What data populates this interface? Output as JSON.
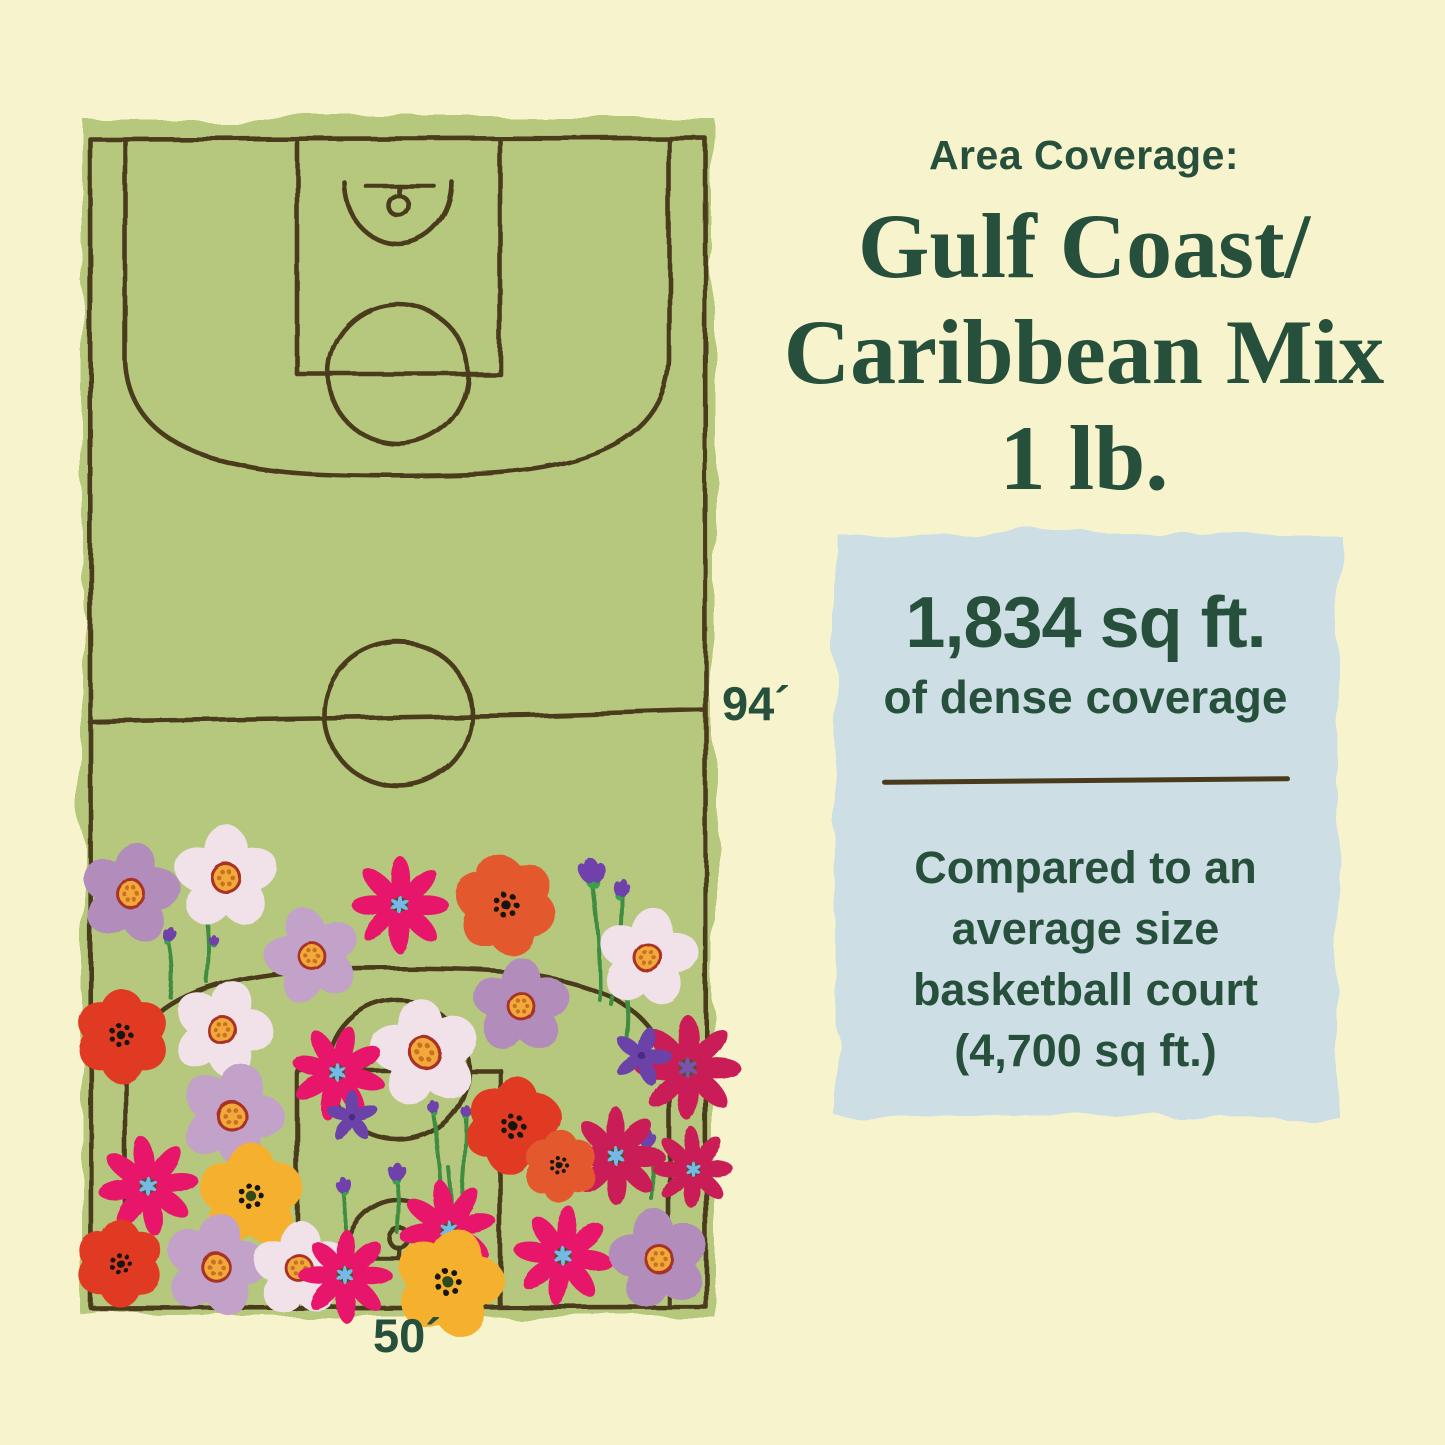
{
  "header": {
    "kicker": "Area Coverage:",
    "title_lines": [
      "Gulf Coast/",
      "Caribbean Mix",
      "1 lb."
    ]
  },
  "infobox": {
    "headline": "1,834 sq ft.",
    "subheadline": "of dense coverage",
    "note": "Compared to an average size basketball court (4,700 sq ft.)"
  },
  "court": {
    "length_label": "94´",
    "width_label": "50´"
  },
  "colors": {
    "background": "#f7f4cd",
    "court_green": "#b5c87b",
    "court_mottle": "#8fa352",
    "line_brown": "#4a3a1c",
    "text_green": "#27503c",
    "infobox_blue": "#cddfe5"
  },
  "illustration": {
    "palette": {
      "lav1": "#b28cba",
      "lav2": "#c2a2c9",
      "pale": "#f1e2ea",
      "mag": "#e7196a",
      "crim": "#ca1e56",
      "red": "#e03b22",
      "org": "#e4592e",
      "yellow": "#f5b12f",
      "iris": "#6b42a8",
      "bud": "#7040ab",
      "bud_green": "#3aa04c",
      "stem": "#3f8c3f",
      "blossom_ring": "#a93328",
      "blossom_disc": "#f1a93a",
      "blossom_dots": "#c96f22",
      "cosmos_disc": "#54512b",
      "star_blue": "#74b9e8",
      "star_purple": "#7a52ad",
      "poppy_dots": "#191208",
      "yellow_disc": "#2f4a1e"
    },
    "stems": [
      [
        600,
        1000,
        592,
        878
      ],
      [
        612,
        1005,
        621,
        892
      ],
      [
        445,
        1252,
        433,
        1112
      ],
      [
        456,
        1252,
        466,
        1116
      ],
      [
        450,
        1256,
        449,
        1168
      ],
      [
        207,
        982,
        206,
        912
      ],
      [
        171,
        998,
        169,
        942
      ],
      [
        397,
        1232,
        396,
        1176
      ],
      [
        344,
        1242,
        342,
        1190
      ],
      [
        651,
        1198,
        648,
        1144
      ],
      [
        627,
        1038,
        624,
        982
      ],
      [
        303,
        970,
        303,
        932
      ]
    ],
    "buds": [
      [
        206,
        903,
        20,
        -10
      ],
      [
        170,
        934,
        13,
        15
      ],
      [
        214,
        940,
        9,
        0
      ],
      [
        592,
        870,
        22,
        -8
      ],
      [
        621,
        886,
        15,
        18
      ],
      [
        433,
        1106,
        11,
        -12
      ],
      [
        466,
        1110,
        10,
        10
      ],
      [
        396,
        1170,
        16,
        0
      ],
      [
        342,
        1183,
        14,
        -12
      ],
      [
        648,
        1138,
        15,
        10
      ],
      [
        624,
        976,
        13,
        0
      ],
      [
        303,
        928,
        13,
        8
      ]
    ],
    "flowers": [
      {
        "t": "blossom",
        "c": "lav1",
        "x": 130,
        "y": 893,
        "r": 50,
        "a": 10
      },
      {
        "t": "blossom",
        "c": "pale",
        "x": 226,
        "y": 878,
        "r": 52,
        "a": 0
      },
      {
        "t": "cosmos",
        "c": "mag",
        "x": 400,
        "y": 905,
        "r": 48,
        "a": 0,
        "s": "star_blue"
      },
      {
        "t": "poppy",
        "c": "org",
        "x": 506,
        "y": 905,
        "r": 52,
        "a": -12
      },
      {
        "t": "blossom",
        "c": "lav2",
        "x": 312,
        "y": 956,
        "r": 48,
        "a": -15
      },
      {
        "t": "blossom",
        "c": "pale",
        "x": 648,
        "y": 958,
        "r": 50,
        "a": 8
      },
      {
        "t": "blossom",
        "c": "lav1",
        "x": 521,
        "y": 1006,
        "r": 48,
        "a": 0
      },
      {
        "t": "poppy",
        "c": "red",
        "x": 122,
        "y": 1036,
        "r": 48,
        "a": 0
      },
      {
        "t": "blossom",
        "c": "pale",
        "x": 222,
        "y": 1030,
        "r": 50,
        "a": 18
      },
      {
        "t": "cosmos",
        "c": "crim",
        "x": 688,
        "y": 1068,
        "r": 52,
        "a": 0,
        "s": "star_purple"
      },
      {
        "t": "iris",
        "x": 642,
        "y": 1056,
        "r": 30,
        "a": 18
      },
      {
        "t": "blossom",
        "c": "pale",
        "x": 425,
        "y": 1053,
        "r": 54,
        "a": -8
      },
      {
        "t": "cosmos",
        "c": "mag",
        "x": 338,
        "y": 1073,
        "r": 47,
        "a": 15,
        "s": "star_blue"
      },
      {
        "t": "blossom",
        "c": "lav2",
        "x": 232,
        "y": 1116,
        "r": 52,
        "a": 20
      },
      {
        "t": "iris",
        "x": 352,
        "y": 1117,
        "r": 27,
        "a": 0
      },
      {
        "t": "poppy",
        "c": "red",
        "x": 513,
        "y": 1126,
        "r": 50,
        "a": 8
      },
      {
        "t": "cosmos",
        "c": "crim",
        "x": 616,
        "y": 1156,
        "r": 48,
        "a": 0,
        "s": "star_blue"
      },
      {
        "t": "cosmos",
        "c": "mag",
        "x": 148,
        "y": 1186,
        "r": 49,
        "a": -8,
        "s": "star_blue"
      },
      {
        "t": "yellow",
        "x": 251,
        "y": 1196,
        "r": 52,
        "a": 0
      },
      {
        "t": "poppy",
        "c": "org",
        "x": 560,
        "y": 1166,
        "r": 38,
        "a": 0
      },
      {
        "t": "cosmos",
        "c": "mag",
        "x": 448,
        "y": 1229,
        "r": 48,
        "a": -10,
        "s": "star_blue"
      },
      {
        "t": "poppy",
        "c": "red",
        "x": 120,
        "y": 1263,
        "r": 45,
        "a": 0
      },
      {
        "t": "blossom",
        "c": "lav2",
        "x": 215,
        "y": 1266,
        "r": 51,
        "a": 12
      },
      {
        "t": "blossom",
        "c": "pale",
        "x": 300,
        "y": 1269,
        "r": 48,
        "a": 0
      },
      {
        "t": "cosmos",
        "c": "mag",
        "x": 346,
        "y": 1276,
        "r": 46,
        "a": 0,
        "s": "star_blue"
      },
      {
        "t": "yellow",
        "x": 449,
        "y": 1283,
        "r": 54,
        "a": 15
      },
      {
        "t": "cosmos",
        "c": "mag",
        "x": 563,
        "y": 1256,
        "r": 49,
        "a": 8,
        "s": "star_blue"
      },
      {
        "t": "blossom",
        "c": "lav1",
        "x": 659,
        "y": 1259,
        "r": 50,
        "a": -10
      },
      {
        "t": "cosmos",
        "c": "crim",
        "x": 692,
        "y": 1168,
        "r": 40,
        "a": 0,
        "s": "star_blue"
      }
    ]
  }
}
